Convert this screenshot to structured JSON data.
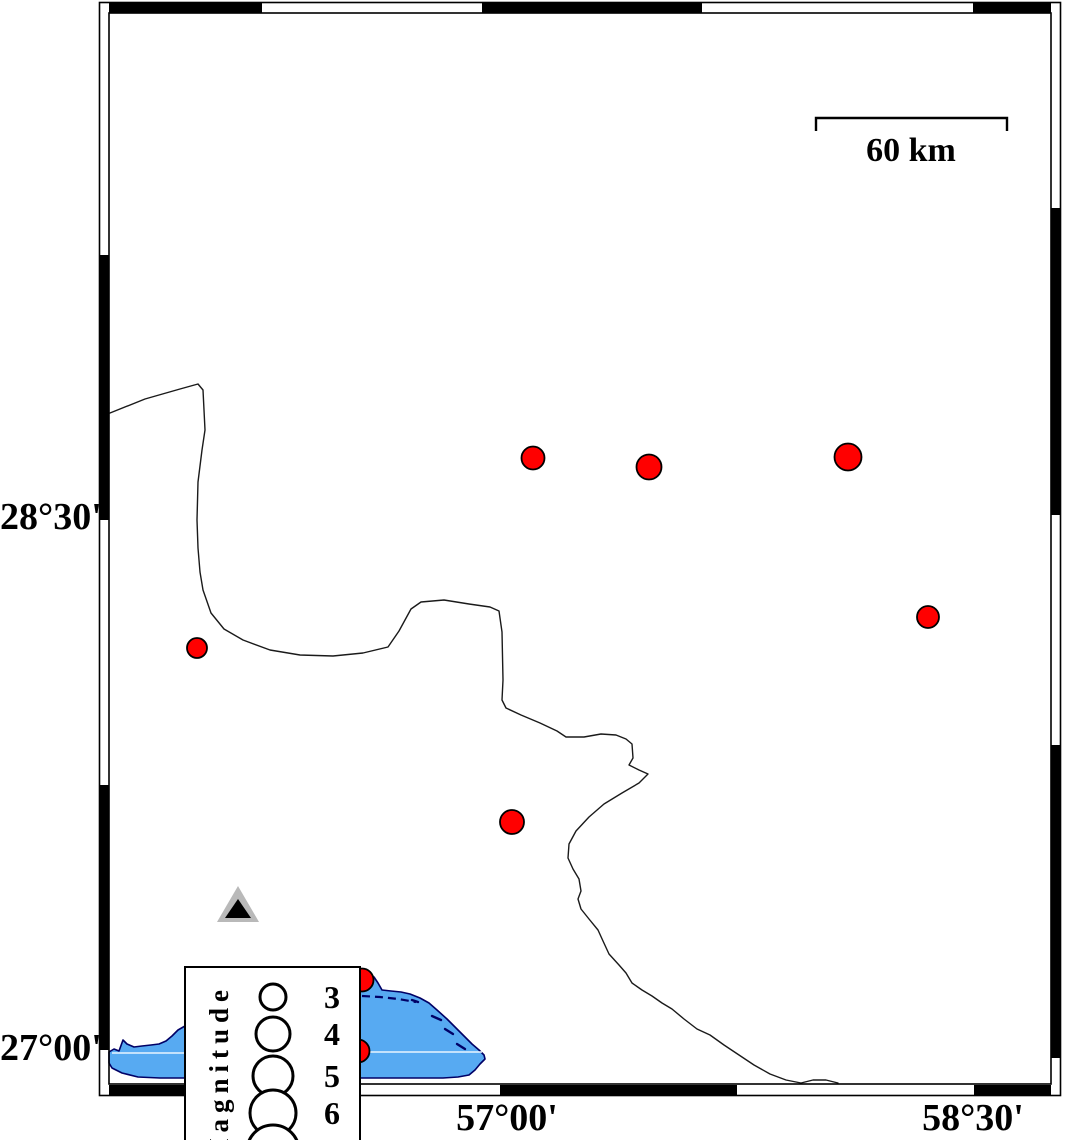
{
  "map": {
    "axis_labels": {
      "left": [
        {
          "text": "28°30'"
        },
        {
          "text": "27°00'"
        }
      ],
      "bottom": [
        {
          "text": "57°00'"
        },
        {
          "text": "58°30'"
        }
      ]
    },
    "scalebar": {
      "label": "60 km"
    },
    "legend": {
      "title": "Magnitude",
      "entries": [
        {
          "label": "3",
          "r": 13,
          "cy": 29
        },
        {
          "label": "4",
          "r": 17,
          "cy": 66
        },
        {
          "label": "5",
          "r": 20,
          "cy": 108
        },
        {
          "label": "6",
          "r": 23,
          "cy": 145
        },
        {
          "label": "",
          "r": 26,
          "cy": 183
        }
      ]
    },
    "epicenters": [
      {
        "x": 533,
        "y": 458,
        "r": 11.5
      },
      {
        "x": 649,
        "y": 467,
        "r": 12.5
      },
      {
        "x": 848,
        "y": 457,
        "r": 13.5
      },
      {
        "x": 928,
        "y": 617,
        "r": 11
      },
      {
        "x": 197,
        "y": 648,
        "r": 10
      },
      {
        "x": 512,
        "y": 822,
        "r": 12
      },
      {
        "x": 362,
        "y": 980,
        "r": 11.5
      },
      {
        "x": 358,
        "y": 1051,
        "r": 11.5
      }
    ],
    "station": {
      "x": 238,
      "y": 907
    },
    "colors": {
      "epicenter": "#ff0000",
      "marker_outline": "#000000",
      "water": "#57aaf2",
      "coastline": "#000066",
      "gridline": "#e8f4ff",
      "boundary_line": "#1a1a1a",
      "station_fill": "#b9b9b9",
      "station_core": "#000000",
      "frame": "#000000"
    }
  }
}
